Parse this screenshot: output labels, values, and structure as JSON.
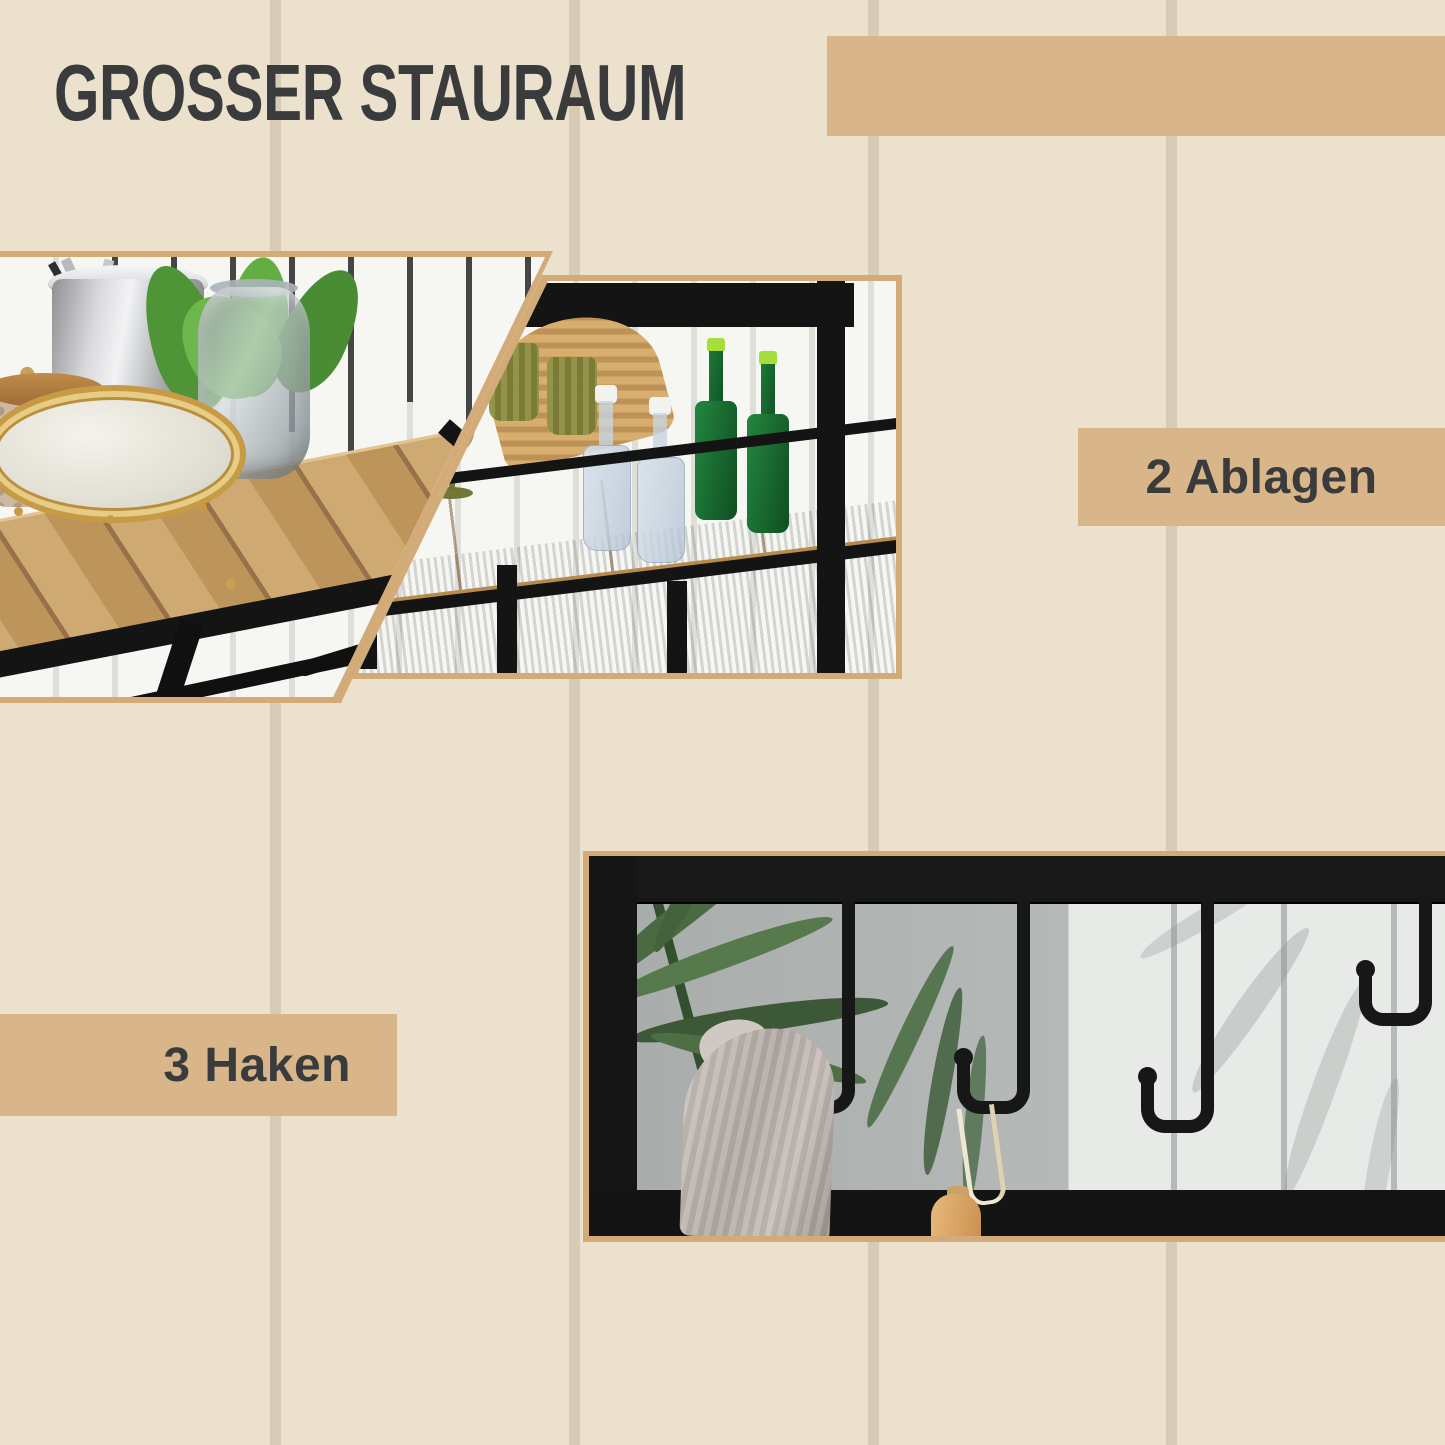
{
  "title": {
    "text": "GROSSER STAURAUM"
  },
  "callouts": {
    "shelves_label": "2 Ablagen",
    "hooks_label": "3 Haken"
  },
  "colors": {
    "background": "#ece1cc",
    "panel-line": "#d7cbb6",
    "accent-tan": "#d8b689",
    "photo-frame-tan": "#d3ab79",
    "text": "#3a3b3d"
  },
  "photos": [
    {
      "name": "tabletop-with-decor"
    },
    {
      "name": "lower-shelf-with-bottles"
    },
    {
      "name": "hook-rail-with-towel"
    }
  ]
}
